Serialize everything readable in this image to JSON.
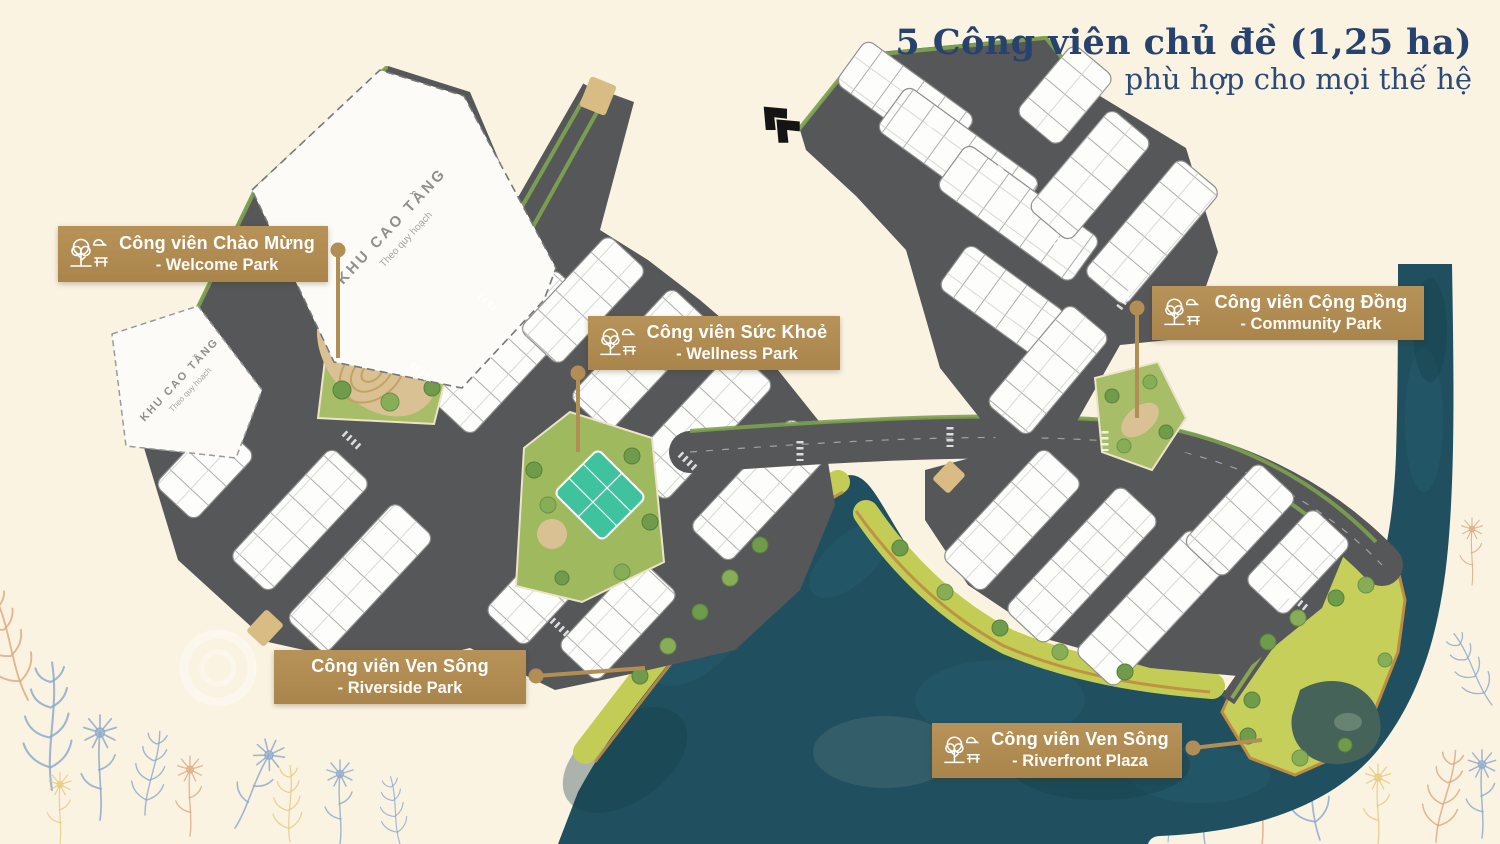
{
  "title": {
    "line1": "5 Công viên chủ đề (1,25 ha)",
    "line2": "phù hợp cho mọi thế hệ"
  },
  "callouts": [
    {
      "id": "welcome",
      "line1": "Công viên Chào Mừng",
      "line2": "- Welcome Park",
      "icon": "park-tree-bench-icon"
    },
    {
      "id": "wellness",
      "line1": "Công viên Sức Khoẻ",
      "line2": "- Wellness Park",
      "icon": "park-tree-bench-icon"
    },
    {
      "id": "community",
      "line1": "Công viên Cộng Đồng",
      "line2": "- Community Park",
      "icon": "park-tree-bench-icon"
    },
    {
      "id": "riverside",
      "line1": "Công viên Ven Sông",
      "line2": "- Riverside Park",
      "icon": null
    },
    {
      "id": "riverfront",
      "line1": "Công viên Ven Sông",
      "line2": "- Riverfront Plaza",
      "icon": "park-tree-bench-icon"
    }
  ],
  "map_labels": {
    "highrise_1": {
      "line1": "KHU CAO TẦNG",
      "line2": "Theo quy hoạch"
    },
    "highrise_2": {
      "line1": "KHU CAO TẦNG",
      "line2": "Theo quy hoạch"
    }
  },
  "colors": {
    "background_cream": "#faf3e2",
    "callout_gold": "#b28e55",
    "title_navy": "#27436d",
    "road_gray": "#565759",
    "river_teal": "#20505f",
    "riverside_green": "#c3cd55",
    "park_green": "#a8bd68",
    "court_teal": "#3fc39e",
    "sand": "#d9c193",
    "coast_orange": "#bf8c42"
  }
}
